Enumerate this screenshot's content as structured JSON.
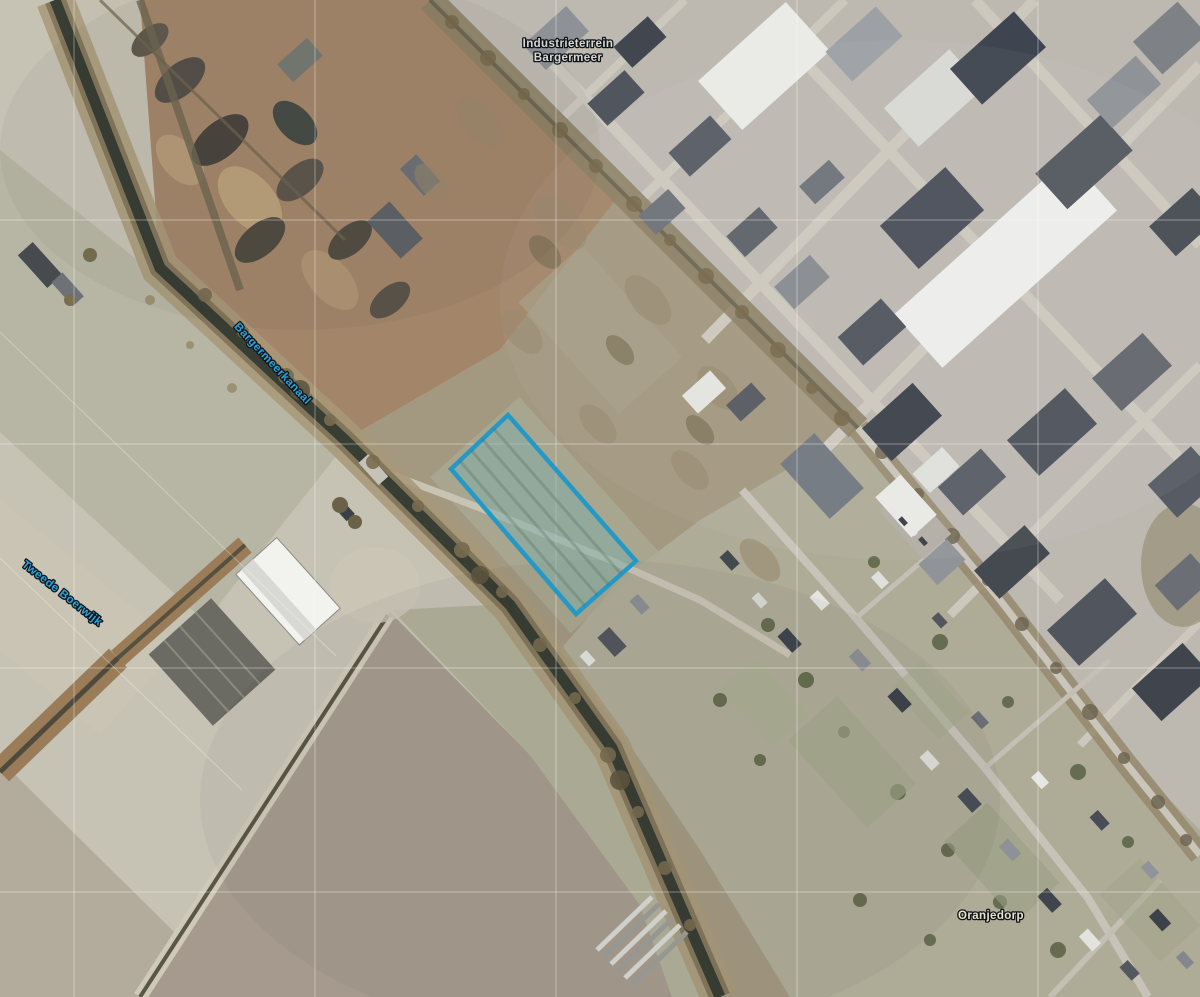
{
  "map": {
    "labels": {
      "industrial_area_line1": "Industrieterrein",
      "industrial_area_line2": "Bargermeer",
      "canal": "Bargermeerkanaal",
      "waterway": "Tweede Boerwijk",
      "village": "Oranjedorp"
    },
    "label_colors": {
      "water_label": "#2aa6dc",
      "area_label": "#d9d9d1",
      "place_label": "#eae3cb",
      "halo": "#10141a"
    },
    "parcel": {
      "points": "508,415 636,561 576,614 451,469",
      "stroke": "#2599c6",
      "fill": "rgba(125,172,167,0.5)"
    },
    "terrain_colors": {
      "fields_pale": "#c6c2b4",
      "field_green_gray": "#b7b5a3",
      "plowed_field": "#a59a8d",
      "scrap_yard_dirt": "#a3866a",
      "brush_corridor": "#a39880",
      "industrial_ground": "#bdb9b1",
      "village_ground": "#aeab97",
      "canal_water": "#383e33",
      "canal_bank": "#a89878",
      "road": "#ccc8be"
    }
  }
}
